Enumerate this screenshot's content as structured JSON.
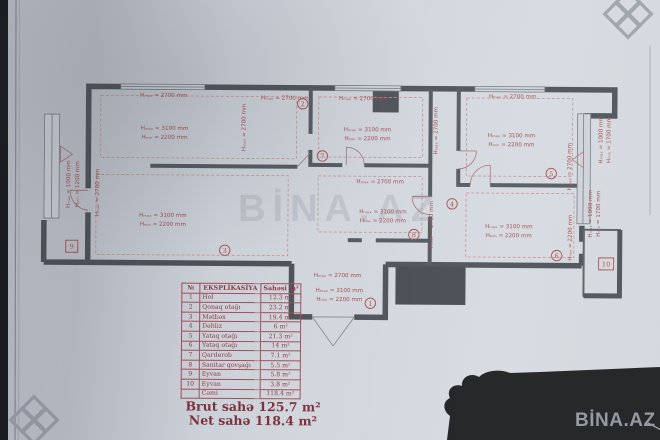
{
  "watermark": {
    "brand": "BİNA.AZ"
  },
  "plan": {
    "dims": {
      "h2700": "Hₘₐₓ = 2700 mm",
      "h3100": "Hₘₐₓ = 3100 mm",
      "h2200": "Hₘᵢₙ = 2200 mm",
      "h1000": "Hₘₐₓ = 1000 mm",
      "h1200": "Hₘᵢₙ = 1200 mm",
      "h1700": "Hₘᵢₙ = 1700 mm"
    },
    "room_numbers": {
      "r1": "1",
      "r2": "2",
      "r3": "3",
      "r4": "4",
      "r5": "5",
      "r6": "6",
      "r7": "7",
      "r8": "8",
      "r9": "9",
      "r10": "10"
    }
  },
  "table": {
    "headers": {
      "num": "№",
      "name": "EKSPLİKASİYA",
      "area": "Sahəsi m²"
    },
    "rows": [
      {
        "num": "1",
        "name": "Hol",
        "area": "12.3 m²"
      },
      {
        "num": "2",
        "name": "Qonaq otağı",
        "area": "23.2 m²"
      },
      {
        "num": "3",
        "name": "Mətbəx",
        "area": "19.4 m²"
      },
      {
        "num": "4",
        "name": "Dəhliz",
        "area": "6 m²"
      },
      {
        "num": "5",
        "name": "Yataq otağı",
        "area": "21.3 m²"
      },
      {
        "num": "6",
        "name": "Yataq otağı",
        "area": "14 m²"
      },
      {
        "num": "7",
        "name": "Qarderob",
        "area": "7.1 m²"
      },
      {
        "num": "8",
        "name": "Sanitar qovşağı",
        "area": "5.5 m²"
      },
      {
        "num": "9",
        "name": "Eyvan",
        "area": "5.8 m²"
      },
      {
        "num": "10",
        "name": "Eyvan",
        "area": "3.8 m²"
      }
    ],
    "total": {
      "num": "",
      "name": "Cəmi",
      "area": "118.4 m²"
    }
  },
  "summary": {
    "brut": "Brut sahə 125.7 m²",
    "net": "Net sahə 118.4 m²"
  }
}
